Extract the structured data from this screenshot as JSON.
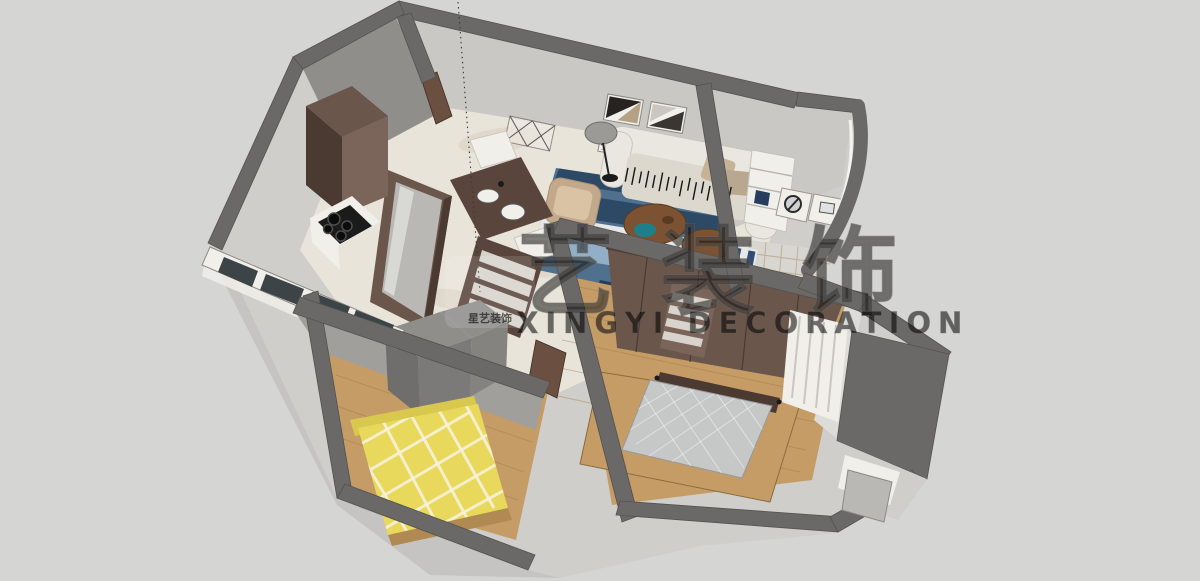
{
  "watermark": {
    "cn_text": "艺装饰",
    "en_text": "XINGYI DECORATION",
    "logo_label": "星艺装饰"
  },
  "scene": {
    "rooms": [
      "kitchen",
      "dining-area",
      "entry-hall",
      "living-room",
      "bathroom",
      "master-bedroom",
      "second-bedroom",
      "bay-window"
    ],
    "objects": [
      "fridge-cabinet",
      "cooktop",
      "dining-table",
      "dining-chairs",
      "plates",
      "bookshelf",
      "mirror-wardrobe",
      "sofa",
      "throw-pillows",
      "macrame-fringe",
      "floor-lamp",
      "armchair",
      "round-coffee-tables",
      "blue-rug",
      "wall-art-grid",
      "x-frame-decor",
      "white-shelf",
      "washing-machine",
      "vanity-counter",
      "wardrobe",
      "ladder-shelf",
      "master-bed",
      "bay-curtain",
      "ac-unit-box",
      "gray-storage-boxes",
      "yellow-bed",
      "entry-door",
      "bedroom-door",
      "guide-line"
    ]
  },
  "palette": {
    "bg": "#d5d5d3",
    "wallTop": "#6a6967",
    "wallEdge": "#53524e",
    "faceLight": "#c9c8c5",
    "faceMid": "#a09f9c",
    "faceDark": "#8f8e8b",
    "exterior": "#cfcecb",
    "marble": "#e9e4da",
    "marbleVein": "#d8d0c0",
    "woodFloor": "#c59c66",
    "plankLine": "#9a7844",
    "furnWoodDark": "#5a453c",
    "furnWood": "#7b655a",
    "wardrobe": "#6b564c",
    "wardrobeDark": "#4a3a32",
    "shelfSlat": "#d8d4cd",
    "sofaCream": "#eae7e0",
    "sofaShade": "#ddd8cd",
    "pillowTan": "#c6b294",
    "rugBase": "#50708f",
    "rugDark": "#2c4a66",
    "rugLight": "#93aec7",
    "rugWhite": "#e5e7e8",
    "tableRound": "#7d5232",
    "teal": "#1d7f8a",
    "yellowBed": "#e8d85c",
    "lattice": "#f6f2da",
    "bedGray": "#c6c8c7",
    "white": "#f1efea",
    "black": "#1b1b1b",
    "glass": "#3d4448",
    "tile": "#d8d6d1",
    "doorBrown": "#6b4f41",
    "navy": "#273d5e",
    "lampShade": "#9b9a97",
    "wmFill": "#eeedе9",
    "wmEdge": "#6c6b67"
  }
}
